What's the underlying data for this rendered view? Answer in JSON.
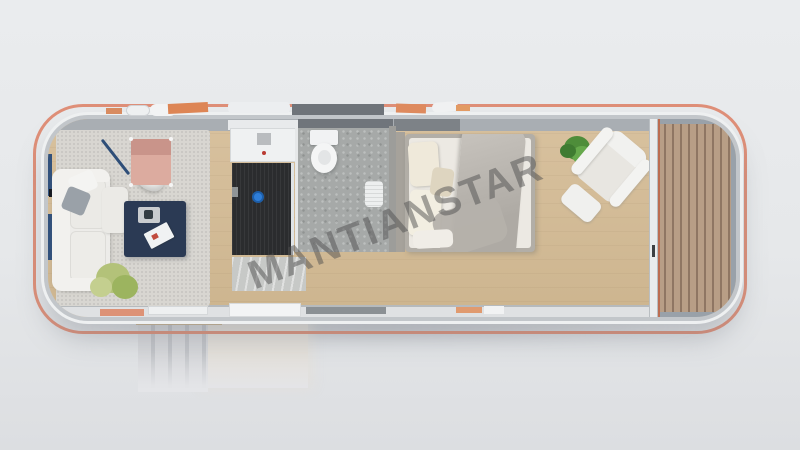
{
  "watermark": {
    "text": "MANTIANSTAR"
  },
  "scene": {
    "type": "3d-render-top-view",
    "subject": "container tiny house floor plan with living room, shower room, bathroom, bedroom, wooden deck and entry stairs"
  },
  "colors": {
    "rim": "#df8f78",
    "wall": "#a9aeb3",
    "wood": "#d8c19e",
    "rug": "#d8d6d1",
    "stone": "#a6a9a8",
    "shower": "#2b2c2e",
    "marble": "#c7c9c7",
    "navy": "#2b3a54",
    "pink": "#dcab9f",
    "sofa": "#edece9",
    "mattress": "#ece9e3",
    "blanket": "#aeaaa4",
    "plant": "#6fa14e",
    "deck": "#b89e86",
    "deck_gap": "#8f7663",
    "deck_frame": "#99a1a9",
    "stairs": "#d2d4d7",
    "landing": "#e4e0da",
    "bg_top": "#eaecee",
    "bg_bottom": "#dcdee1"
  },
  "objects": [
    "container-home",
    "living-room-rug",
    "sofa",
    "floor-lamp",
    "lounge-chair",
    "coffee-table",
    "magazine",
    "tray",
    "potted-plant-living",
    "kitchen-vanity",
    "shower-floor",
    "shower-knob",
    "marble-counter",
    "bathroom-floor",
    "toilet",
    "bath-mat",
    "partition-wall",
    "bed",
    "pillows",
    "blanket",
    "potted-plant-bedroom",
    "armchair",
    "ottoman",
    "glass-door",
    "wooden-deck",
    "entry-stairs",
    "landing-platform"
  ]
}
